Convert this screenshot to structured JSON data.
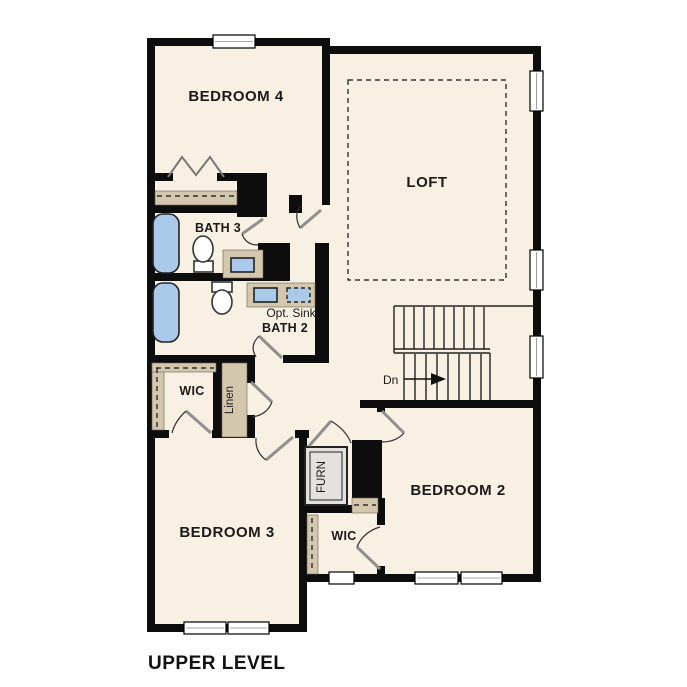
{
  "title": "UPPER LEVEL",
  "labels": {
    "bedroom4": "BEDROOM 4",
    "loft": "LOFT",
    "bath3": "BATH 3",
    "bath2": "BATH 2",
    "opt_sink": "Opt. Sink",
    "wic_hall": "WIC",
    "linen": "Linen",
    "bedroom3": "BEDROOM 3",
    "furnace": "FURN",
    "bedroom2": "BEDROOM 2",
    "wic_bedroom2": "WIC",
    "stairs_direction": "Dn"
  },
  "colors": {
    "wall": "#0d0d0d",
    "floor": "#f7f0e3",
    "fixture_blue": "#abc9e9",
    "shelf_tan": "#d3c7ae",
    "door_gray": "#8f8f8f",
    "furnace_gray": "#e3e2de",
    "background": "#ffffff"
  }
}
